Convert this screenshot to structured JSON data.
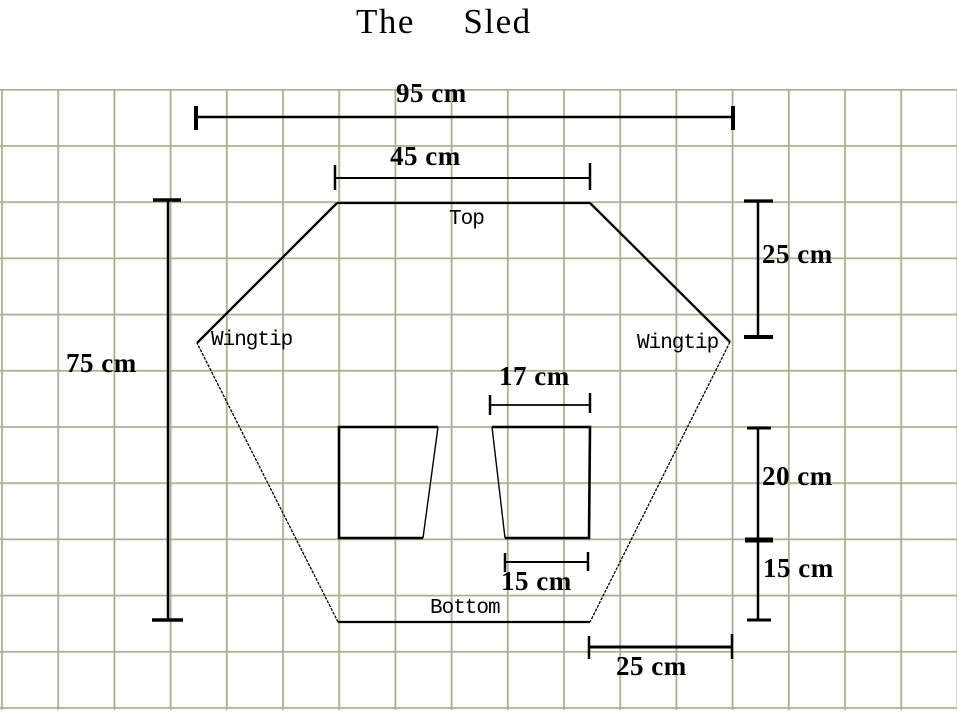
{
  "title": "The  Sled",
  "labels": {
    "top": "Top",
    "bottom": "Bottom",
    "wingtip_left": "Wingtip",
    "wingtip_right": "Wingtip"
  },
  "dimensions": {
    "overall_width": "95 cm",
    "top_edge": "45 cm",
    "upper_right_height": "25 cm",
    "overall_height": "75 cm",
    "runner_top_width": "17 cm",
    "runner_height": "20 cm",
    "below_runner_height": "15 cm",
    "runner_bottom_width": "15 cm",
    "bottom_right_offset": "25 cm"
  },
  "colors": {
    "grid": "#adad92",
    "ink": "#000000",
    "background": "#ffffff"
  }
}
